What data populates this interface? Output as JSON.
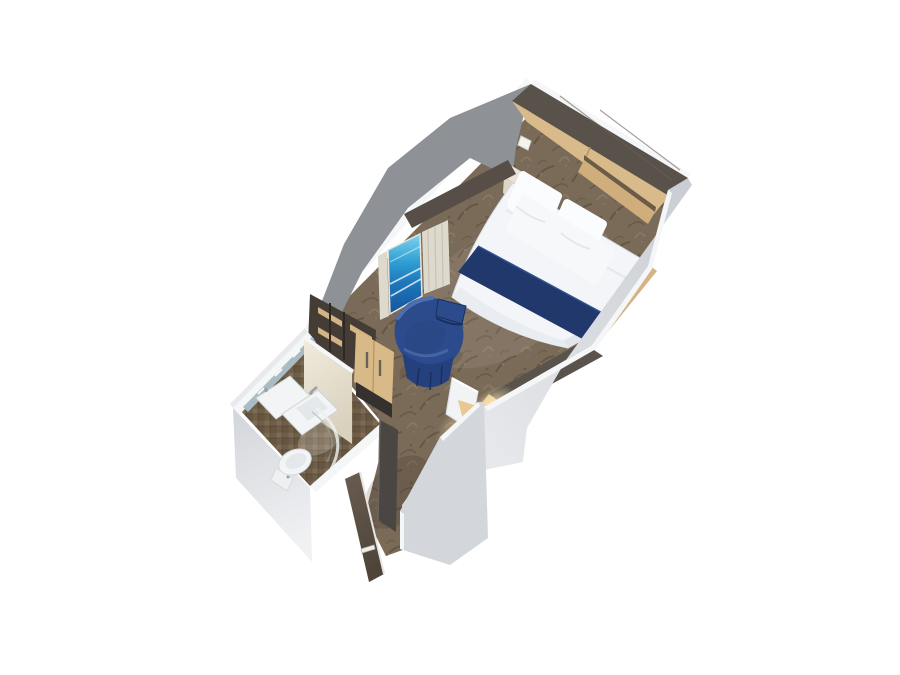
{
  "scene": {
    "description": "3D overhead cutaway render of an interior cruise-ship stateroom floor plan on a plain white background",
    "view": "isometric cutaway, room angled diagonally, entry corridor at bottom, bed at top",
    "background": "#ffffff"
  },
  "objects": [
    {
      "name": "headboard-wall",
      "label": "dark wood headboard wall"
    },
    {
      "name": "overhead-cabinets",
      "label": "tan overhead storage cabinets above bed"
    },
    {
      "name": "nightstand",
      "label": "bedside nightstand"
    },
    {
      "name": "wall-sconce",
      "label": "small white wall lamp"
    },
    {
      "name": "bed",
      "label": "double bed, white duvet, navy runner, four pillows"
    },
    {
      "name": "virtual-balcony-screen",
      "label": "blue virtual-balcony screen with curtains"
    },
    {
      "name": "window-valance",
      "label": "dark wood valance above screen"
    },
    {
      "name": "wardrobe",
      "label": "wardrobe with open shelves and two tan doors"
    },
    {
      "name": "tub-chair",
      "label": "round navy-blue tub chair"
    },
    {
      "name": "desk",
      "label": "dark-topped vanity desk with warm under-light"
    },
    {
      "name": "desk-chair",
      "label": "white desk chair"
    },
    {
      "name": "bathroom",
      "label": "bathroom with shower, sink and toilet on brown mosaic tile"
    },
    {
      "name": "bathroom-door",
      "label": "dark bathroom door panel in corridor"
    },
    {
      "name": "entry-door",
      "label": "dark wood entry door shown open outside the cut wall"
    },
    {
      "name": "carpet",
      "label": "patterned brown carpet"
    }
  ],
  "colors": {
    "bg": "#ffffff",
    "wallTop": "#f5f6f8",
    "wallOuter": "#d3d6db",
    "wallOuterLight": "#e7e9ec",
    "wallInnerGray": "#8e9196",
    "headboardWood": "#59524b",
    "headboardGrain": "#6a6158",
    "cabinetTan": "#d9ba8a",
    "cabinetTanDark": "#cfae7c",
    "cabinetDivider": "#6b5b49",
    "valanceDark": "#574f47",
    "curtain": "#ded9cd",
    "curtainStripe": "#c6c0b2",
    "wardrobeCase": "#443c35",
    "shelfTan": "#d3b486",
    "doorTan": "#d8b988",
    "doorSeam": "#b6945f",
    "doorBase": "#34312e",
    "handleDark": "#6b6257",
    "bedWhite": "#f3f5f8",
    "bedShadeRight": "#e2e6eb",
    "bedShadeFoot": "#e9edf1",
    "bedEdge": "#d8dce1",
    "pillow": "#fbfcfd",
    "pillowFront": "#f6f8fa",
    "pillowShade": "#e0e4e9",
    "runner": "#20386b",
    "runnerLight": "#31508f",
    "benchTan": "#d4b384",
    "deskDark": "#59534c",
    "deskSide": "#3f3a35",
    "deskFront": "#e9c892",
    "chairWhite": "#f2f3f5",
    "chairWhiteEdge": "#d8dbde",
    "blueShell": "#2c4b8c",
    "blueSeat": "#2a4885",
    "blueSkirt": "#24417d",
    "blueDeep": "#1a2f5e",
    "blueLight": "#4e6fae",
    "carpetBase": "#7a6a58",
    "carpetDark": "#5d4e3e",
    "carpetLight": "#8f7e67",
    "tileBase": "#6f5e48",
    "tileAlt": "#7d6b52",
    "tileDark": "#66553f",
    "fixtureWhite": "#f2f4f5",
    "fixtureShade": "#e4e8ea",
    "fixtureEdge": "#ccd3d6",
    "chrome": "#9aa2a8",
    "mirror": "#a9bcc4",
    "creamTop": "#f1ebdd",
    "creamBottom": "#d9d1bd",
    "bathDoor": "#4a4643",
    "bathDoorEdge": "#6a655f",
    "entryDoorTop": "#6a5d50",
    "entryDoorBottom": "#4e443a",
    "entryDoorEdge": "#e8e6e2",
    "glow": "#ffe3a8"
  }
}
